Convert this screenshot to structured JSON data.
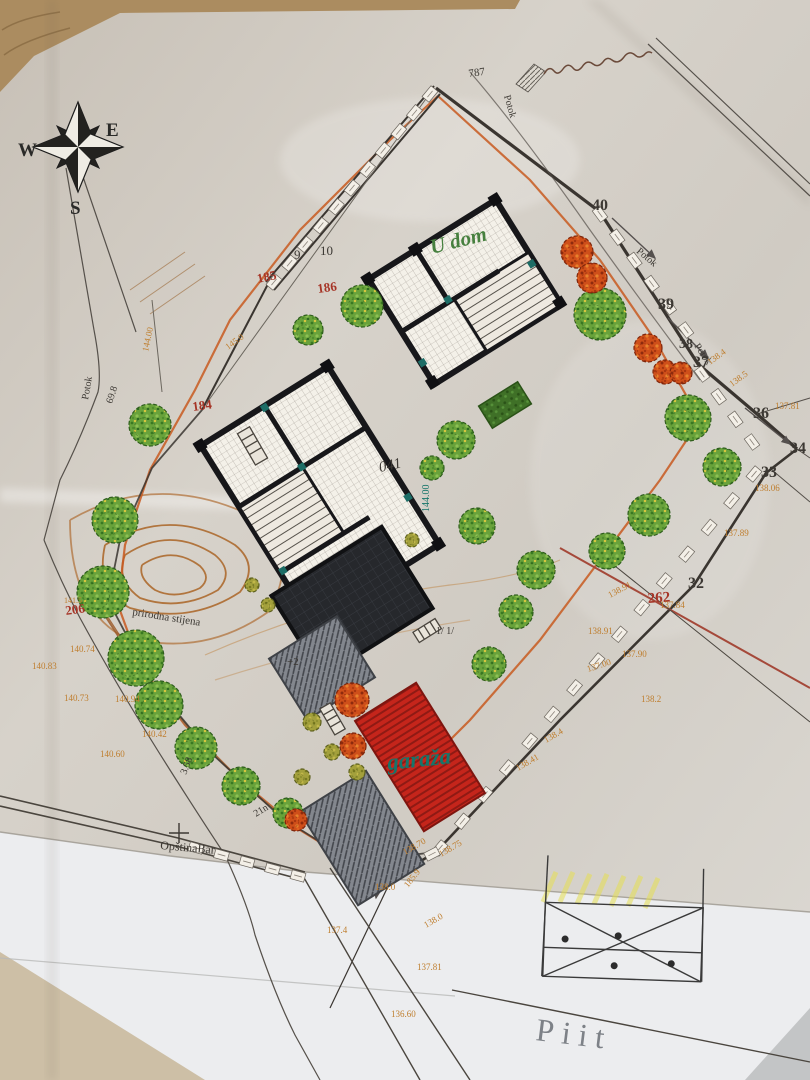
{
  "compass": {
    "west": "W",
    "east": "E",
    "south": "S"
  },
  "colors": {
    "dark": "#3c3833",
    "red": "#a63527",
    "orange": "#bf7e2e",
    "teal": "#16756a",
    "green": "#47803f",
    "gray": "#7d8187",
    "paper": "#d2ccc3",
    "under_sheet": "#ecedef",
    "boundary": "#3a3530",
    "garage_red": "#c5251b",
    "roof_dark": "#26282c",
    "contour": "#ad6a2e",
    "orange_line": "#c85a20",
    "tree_green": "#69a23b",
    "tree_autumn": "#cf4f1a"
  },
  "plan": {
    "labels": [
      {
        "text": "787",
        "x": 469,
        "y": 77,
        "rot": -8,
        "size": 11,
        "color": "dark"
      },
      {
        "text": "9",
        "x": 294,
        "y": 259,
        "rot": 0,
        "size": 13,
        "color": "dark"
      },
      {
        "text": "10",
        "x": 320,
        "y": 255,
        "rot": 0,
        "size": 13,
        "color": "dark"
      },
      {
        "text": "40",
        "x": 592,
        "y": 210,
        "rot": 0,
        "size": 16,
        "color": "dark",
        "bold": true
      },
      {
        "text": "39",
        "x": 658,
        "y": 309,
        "rot": 0,
        "size": 16,
        "color": "dark",
        "bold": true
      },
      {
        "text": "38",
        "x": 679,
        "y": 348,
        "rot": 0,
        "size": 14,
        "color": "dark",
        "bold": true
      },
      {
        "text": "37",
        "x": 693,
        "y": 367,
        "rot": 0,
        "size": 16,
        "color": "dark",
        "bold": true
      },
      {
        "text": "36",
        "x": 753,
        "y": 418,
        "rot": 0,
        "size": 16,
        "color": "dark",
        "bold": true
      },
      {
        "text": "34",
        "x": 790,
        "y": 453,
        "rot": 0,
        "size": 16,
        "color": "dark",
        "bold": true
      },
      {
        "text": "33",
        "x": 761,
        "y": 477,
        "rot": 0,
        "size": 16,
        "color": "dark",
        "bold": true
      },
      {
        "text": "32",
        "x": 688,
        "y": 588,
        "rot": 0,
        "size": 16,
        "color": "dark",
        "bold": true
      },
      {
        "text": "185",
        "x": 258,
        "y": 283,
        "rot": -12,
        "size": 13,
        "color": "red",
        "bold": true
      },
      {
        "text": "186",
        "x": 318,
        "y": 293,
        "rot": -8,
        "size": 13,
        "color": "red",
        "bold": true
      },
      {
        "text": "184",
        "x": 193,
        "y": 411,
        "rot": -8,
        "size": 13,
        "color": "red",
        "bold": true
      },
      {
        "text": "206",
        "x": 66,
        "y": 615,
        "rot": -8,
        "size": 13,
        "color": "red",
        "bold": true
      },
      {
        "text": "262",
        "x": 648,
        "y": 603,
        "rot": -4,
        "size": 15,
        "color": "red",
        "bold": true
      },
      {
        "text": "U dom",
        "x": 432,
        "y": 254,
        "rot": -14,
        "size": 21,
        "color": "green",
        "italic": true,
        "bold": true
      },
      {
        "text": "garaža",
        "x": 388,
        "y": 770,
        "rot": -6,
        "size": 23,
        "color": "teal",
        "italic": true,
        "bold": true
      },
      {
        "text": "041",
        "x": 380,
        "y": 472,
        "rot": -12,
        "size": 15,
        "color": "dark",
        "italic": true
      },
      {
        "text": "OpštinaBar",
        "x": 160,
        "y": 849,
        "rot": 5,
        "size": 12,
        "color": "dark"
      },
      {
        "text": "prirodna stijena",
        "x": 132,
        "y": 615,
        "rot": 9,
        "size": 11,
        "color": "dark"
      },
      {
        "text": "Piit",
        "x": 535,
        "y": 1040,
        "rot": 7,
        "size": 32,
        "color": "gray",
        "ls": 8
      },
      {
        "text": "Potok",
        "x": 504,
        "y": 96,
        "rot": 74,
        "size": 10,
        "color": "dark"
      },
      {
        "text": "Potok",
        "x": 636,
        "y": 252,
        "rot": 40,
        "size": 10,
        "color": "dark"
      },
      {
        "text": "Potok",
        "x": 694,
        "y": 346,
        "rot": 56,
        "size": 10,
        "color": "dark"
      },
      {
        "text": "Potok",
        "x": 88,
        "y": 400,
        "rot": -80,
        "size": 10,
        "color": "dark"
      },
      {
        "text": "69.8",
        "x": 112,
        "y": 404,
        "rot": -72,
        "size": 10,
        "color": "dark"
      },
      {
        "text": "3.58",
        "x": 186,
        "y": 775,
        "rot": -68,
        "size": 10,
        "color": "dark"
      },
      {
        "text": "21n",
        "x": 256,
        "y": 817,
        "rot": -32,
        "size": 10,
        "color": "dark"
      },
      {
        "text": "144.00",
        "x": 429,
        "y": 512,
        "rot": -90,
        "size": 10,
        "color": "teal"
      },
      {
        "text": "144.00",
        "x": 148,
        "y": 352,
        "rot": -78,
        "size": 9,
        "color": "orange"
      },
      {
        "text": "145.0",
        "x": 228,
        "y": 350,
        "rot": -36,
        "size": 9,
        "color": "orange"
      },
      {
        "text": "138.4",
        "x": 710,
        "y": 365,
        "rot": -36,
        "size": 9,
        "color": "orange"
      },
      {
        "text": "138.5",
        "x": 732,
        "y": 387,
        "rot": -36,
        "size": 9,
        "color": "orange"
      },
      {
        "text": "137.81",
        "x": 775,
        "y": 409,
        "rot": 0,
        "size": 9,
        "color": "orange"
      },
      {
        "text": "138.06",
        "x": 755,
        "y": 491,
        "rot": 0,
        "size": 9,
        "color": "orange"
      },
      {
        "text": "137.89",
        "x": 724,
        "y": 536,
        "rot": 0,
        "size": 9,
        "color": "orange"
      },
      {
        "text": "138.91",
        "x": 610,
        "y": 598,
        "rot": -28,
        "size": 9,
        "color": "orange"
      },
      {
        "text": "137.84",
        "x": 660,
        "y": 608,
        "rot": 0,
        "size": 9,
        "color": "orange"
      },
      {
        "text": "138.91",
        "x": 588,
        "y": 634,
        "rot": 0,
        "size": 9,
        "color": "orange"
      },
      {
        "text": "137.90",
        "x": 622,
        "y": 657,
        "rot": 0,
        "size": 9,
        "color": "orange"
      },
      {
        "text": "137.00",
        "x": 588,
        "y": 672,
        "rot": -18,
        "size": 9,
        "color": "orange"
      },
      {
        "text": "138.2",
        "x": 641,
        "y": 702,
        "rot": 0,
        "size": 9,
        "color": "orange"
      },
      {
        "text": "138.4",
        "x": 546,
        "y": 743,
        "rot": -30,
        "size": 9,
        "color": "orange"
      },
      {
        "text": "138.41",
        "x": 518,
        "y": 771,
        "rot": -30,
        "size": 9,
        "color": "orange"
      },
      {
        "text": "138.70",
        "x": 405,
        "y": 855,
        "rot": -30,
        "size": 9,
        "color": "orange"
      },
      {
        "text": "138.75",
        "x": 441,
        "y": 857,
        "rot": -30,
        "size": 9,
        "color": "orange"
      },
      {
        "text": "138.0",
        "x": 375,
        "y": 890,
        "rot": 0,
        "size": 9,
        "color": "orange"
      },
      {
        "text": "185.9",
        "x": 408,
        "y": 888,
        "rot": -52,
        "size": 9,
        "color": "orange"
      },
      {
        "text": "137.4",
        "x": 327,
        "y": 933,
        "rot": 0,
        "size": 9,
        "color": "orange"
      },
      {
        "text": "138.0",
        "x": 426,
        "y": 928,
        "rot": -30,
        "size": 9,
        "color": "orange"
      },
      {
        "text": "137.81",
        "x": 417,
        "y": 970,
        "rot": 0,
        "size": 9,
        "color": "orange"
      },
      {
        "text": "136.60",
        "x": 391,
        "y": 1017,
        "rot": 0,
        "size": 9,
        "color": "orange"
      },
      {
        "text": "140.74",
        "x": 70,
        "y": 652,
        "rot": 0,
        "size": 9,
        "color": "orange"
      },
      {
        "text": "140.83",
        "x": 32,
        "y": 669,
        "rot": 0,
        "size": 9,
        "color": "orange"
      },
      {
        "text": "140.73",
        "x": 64,
        "y": 701,
        "rot": 0,
        "size": 9,
        "color": "orange"
      },
      {
        "text": "140.94",
        "x": 115,
        "y": 702,
        "rot": 0,
        "size": 9,
        "color": "orange"
      },
      {
        "text": "140.42",
        "x": 142,
        "y": 737,
        "rot": 0,
        "size": 9,
        "color": "orange"
      },
      {
        "text": "140.60",
        "x": 100,
        "y": 757,
        "rot": 0,
        "size": 9,
        "color": "orange"
      },
      {
        "text": "141.5",
        "x": 64,
        "y": 603,
        "rot": 0,
        "size": 8,
        "color": "orange"
      },
      {
        "text": "+2",
        "x": 287,
        "y": 665,
        "rot": 0,
        "size": 11,
        "color": "dark"
      },
      {
        "text": "1/  1/",
        "x": 436,
        "y": 634,
        "rot": 0,
        "size": 10,
        "color": "dark"
      }
    ],
    "trees": [
      {
        "x": 150,
        "y": 425,
        "r": 21,
        "kind": "green"
      },
      {
        "x": 115,
        "y": 520,
        "r": 23,
        "kind": "green"
      },
      {
        "x": 103,
        "y": 592,
        "r": 26,
        "kind": "green"
      },
      {
        "x": 136,
        "y": 658,
        "r": 28,
        "kind": "green"
      },
      {
        "x": 159,
        "y": 705,
        "r": 24,
        "kind": "green"
      },
      {
        "x": 196,
        "y": 748,
        "r": 21,
        "kind": "green"
      },
      {
        "x": 241,
        "y": 786,
        "r": 19,
        "kind": "green"
      },
      {
        "x": 288,
        "y": 813,
        "r": 15,
        "kind": "green"
      },
      {
        "x": 362,
        "y": 306,
        "r": 21,
        "kind": "green"
      },
      {
        "x": 308,
        "y": 330,
        "r": 15,
        "kind": "green"
      },
      {
        "x": 600,
        "y": 314,
        "r": 26,
        "kind": "green"
      },
      {
        "x": 688,
        "y": 418,
        "r": 23,
        "kind": "green"
      },
      {
        "x": 722,
        "y": 467,
        "r": 19,
        "kind": "green"
      },
      {
        "x": 649,
        "y": 515,
        "r": 21,
        "kind": "green"
      },
      {
        "x": 607,
        "y": 551,
        "r": 18,
        "kind": "green"
      },
      {
        "x": 456,
        "y": 440,
        "r": 19,
        "kind": "green"
      },
      {
        "x": 477,
        "y": 526,
        "r": 18,
        "kind": "green"
      },
      {
        "x": 536,
        "y": 570,
        "r": 19,
        "kind": "green"
      },
      {
        "x": 516,
        "y": 612,
        "r": 17,
        "kind": "green"
      },
      {
        "x": 489,
        "y": 664,
        "r": 17,
        "kind": "green"
      },
      {
        "x": 432,
        "y": 468,
        "r": 12,
        "kind": "green"
      },
      {
        "x": 577,
        "y": 252,
        "r": 16,
        "kind": "orange"
      },
      {
        "x": 592,
        "y": 278,
        "r": 15,
        "kind": "orange"
      },
      {
        "x": 648,
        "y": 348,
        "r": 14,
        "kind": "orange"
      },
      {
        "x": 665,
        "y": 372,
        "r": 12,
        "kind": "orange"
      },
      {
        "x": 681,
        "y": 373,
        "r": 11,
        "kind": "orange"
      },
      {
        "x": 352,
        "y": 700,
        "r": 17,
        "kind": "orange"
      },
      {
        "x": 353,
        "y": 746,
        "r": 13,
        "kind": "orange"
      },
      {
        "x": 296,
        "y": 820,
        "r": 11,
        "kind": "orange"
      },
      {
        "x": 312,
        "y": 722,
        "r": 9,
        "kind": "bush"
      },
      {
        "x": 332,
        "y": 752,
        "r": 8,
        "kind": "bush"
      },
      {
        "x": 302,
        "y": 777,
        "r": 8,
        "kind": "bush"
      },
      {
        "x": 357,
        "y": 772,
        "r": 8,
        "kind": "bush"
      },
      {
        "x": 252,
        "y": 585,
        "r": 7,
        "kind": "bush"
      },
      {
        "x": 268,
        "y": 605,
        "r": 7,
        "kind": "bush"
      },
      {
        "x": 412,
        "y": 540,
        "r": 7,
        "kind": "bush"
      }
    ],
    "tick_chains": [
      {
        "x1": 274,
        "y1": 282,
        "x2": 430,
        "y2": 94,
        "n": 11
      },
      {
        "x1": 600,
        "y1": 214,
        "x2": 686,
        "y2": 330,
        "n": 6
      },
      {
        "x1": 754,
        "y1": 474,
        "x2": 440,
        "y2": 848,
        "n": 15
      },
      {
        "x1": 702,
        "y1": 374,
        "x2": 752,
        "y2": 442,
        "n": 4
      },
      {
        "x1": 432,
        "y1": 854,
        "x2": 366,
        "y2": 888,
        "n": 4
      },
      {
        "x1": 196,
        "y1": 848,
        "x2": 298,
        "y2": 876,
        "n": 5
      }
    ]
  }
}
